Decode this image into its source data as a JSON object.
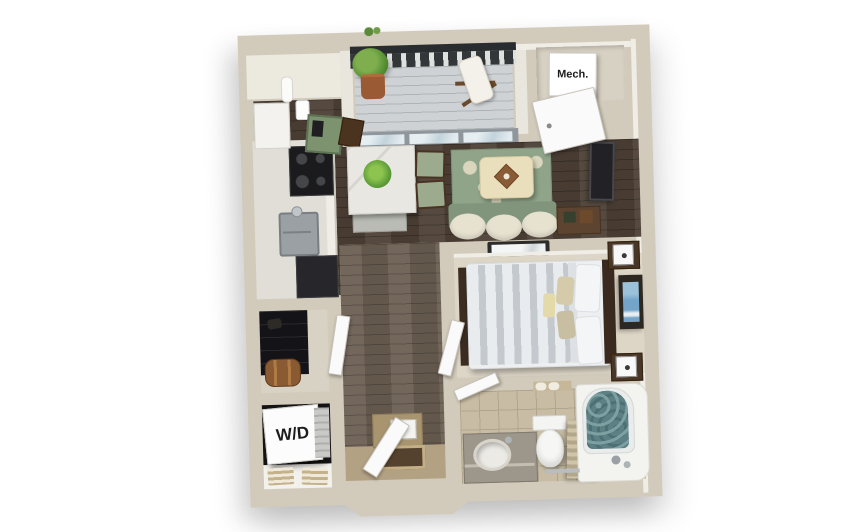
{
  "labels": {
    "mech_closet": "Mech.",
    "washer_dryer": "W/D"
  },
  "colors": {
    "background": "#ffffff",
    "wall": "#d2cbbb",
    "wall_lit_face": "#efede5",
    "wood_floor": "#4d4036",
    "hallway_floor": "#6a5e52",
    "entry_floor": "#b3a183",
    "bedroom_carpet": "#ddd6c7",
    "bathroom_tile": "#c8bda4",
    "balcony_deck": "#ced2d5",
    "railing": "#2e3133",
    "area_rug_green": "#8fa489",
    "sofa_green": "#81957c",
    "cushion_cream": "#e7e2d0",
    "ottoman_cream": "#eadfbd",
    "table_marble": "#e9e7e2",
    "chair_green": "#9cab8e",
    "furniture_wood": "#4a3626",
    "appliance_black": "#1b1b1d",
    "duvet_stripe_gray": "#c4c9ce",
    "wall_art_blue": "#74a5c8",
    "shower_curtain_teal": "#5d8084",
    "closet_interior": "#141416"
  }
}
